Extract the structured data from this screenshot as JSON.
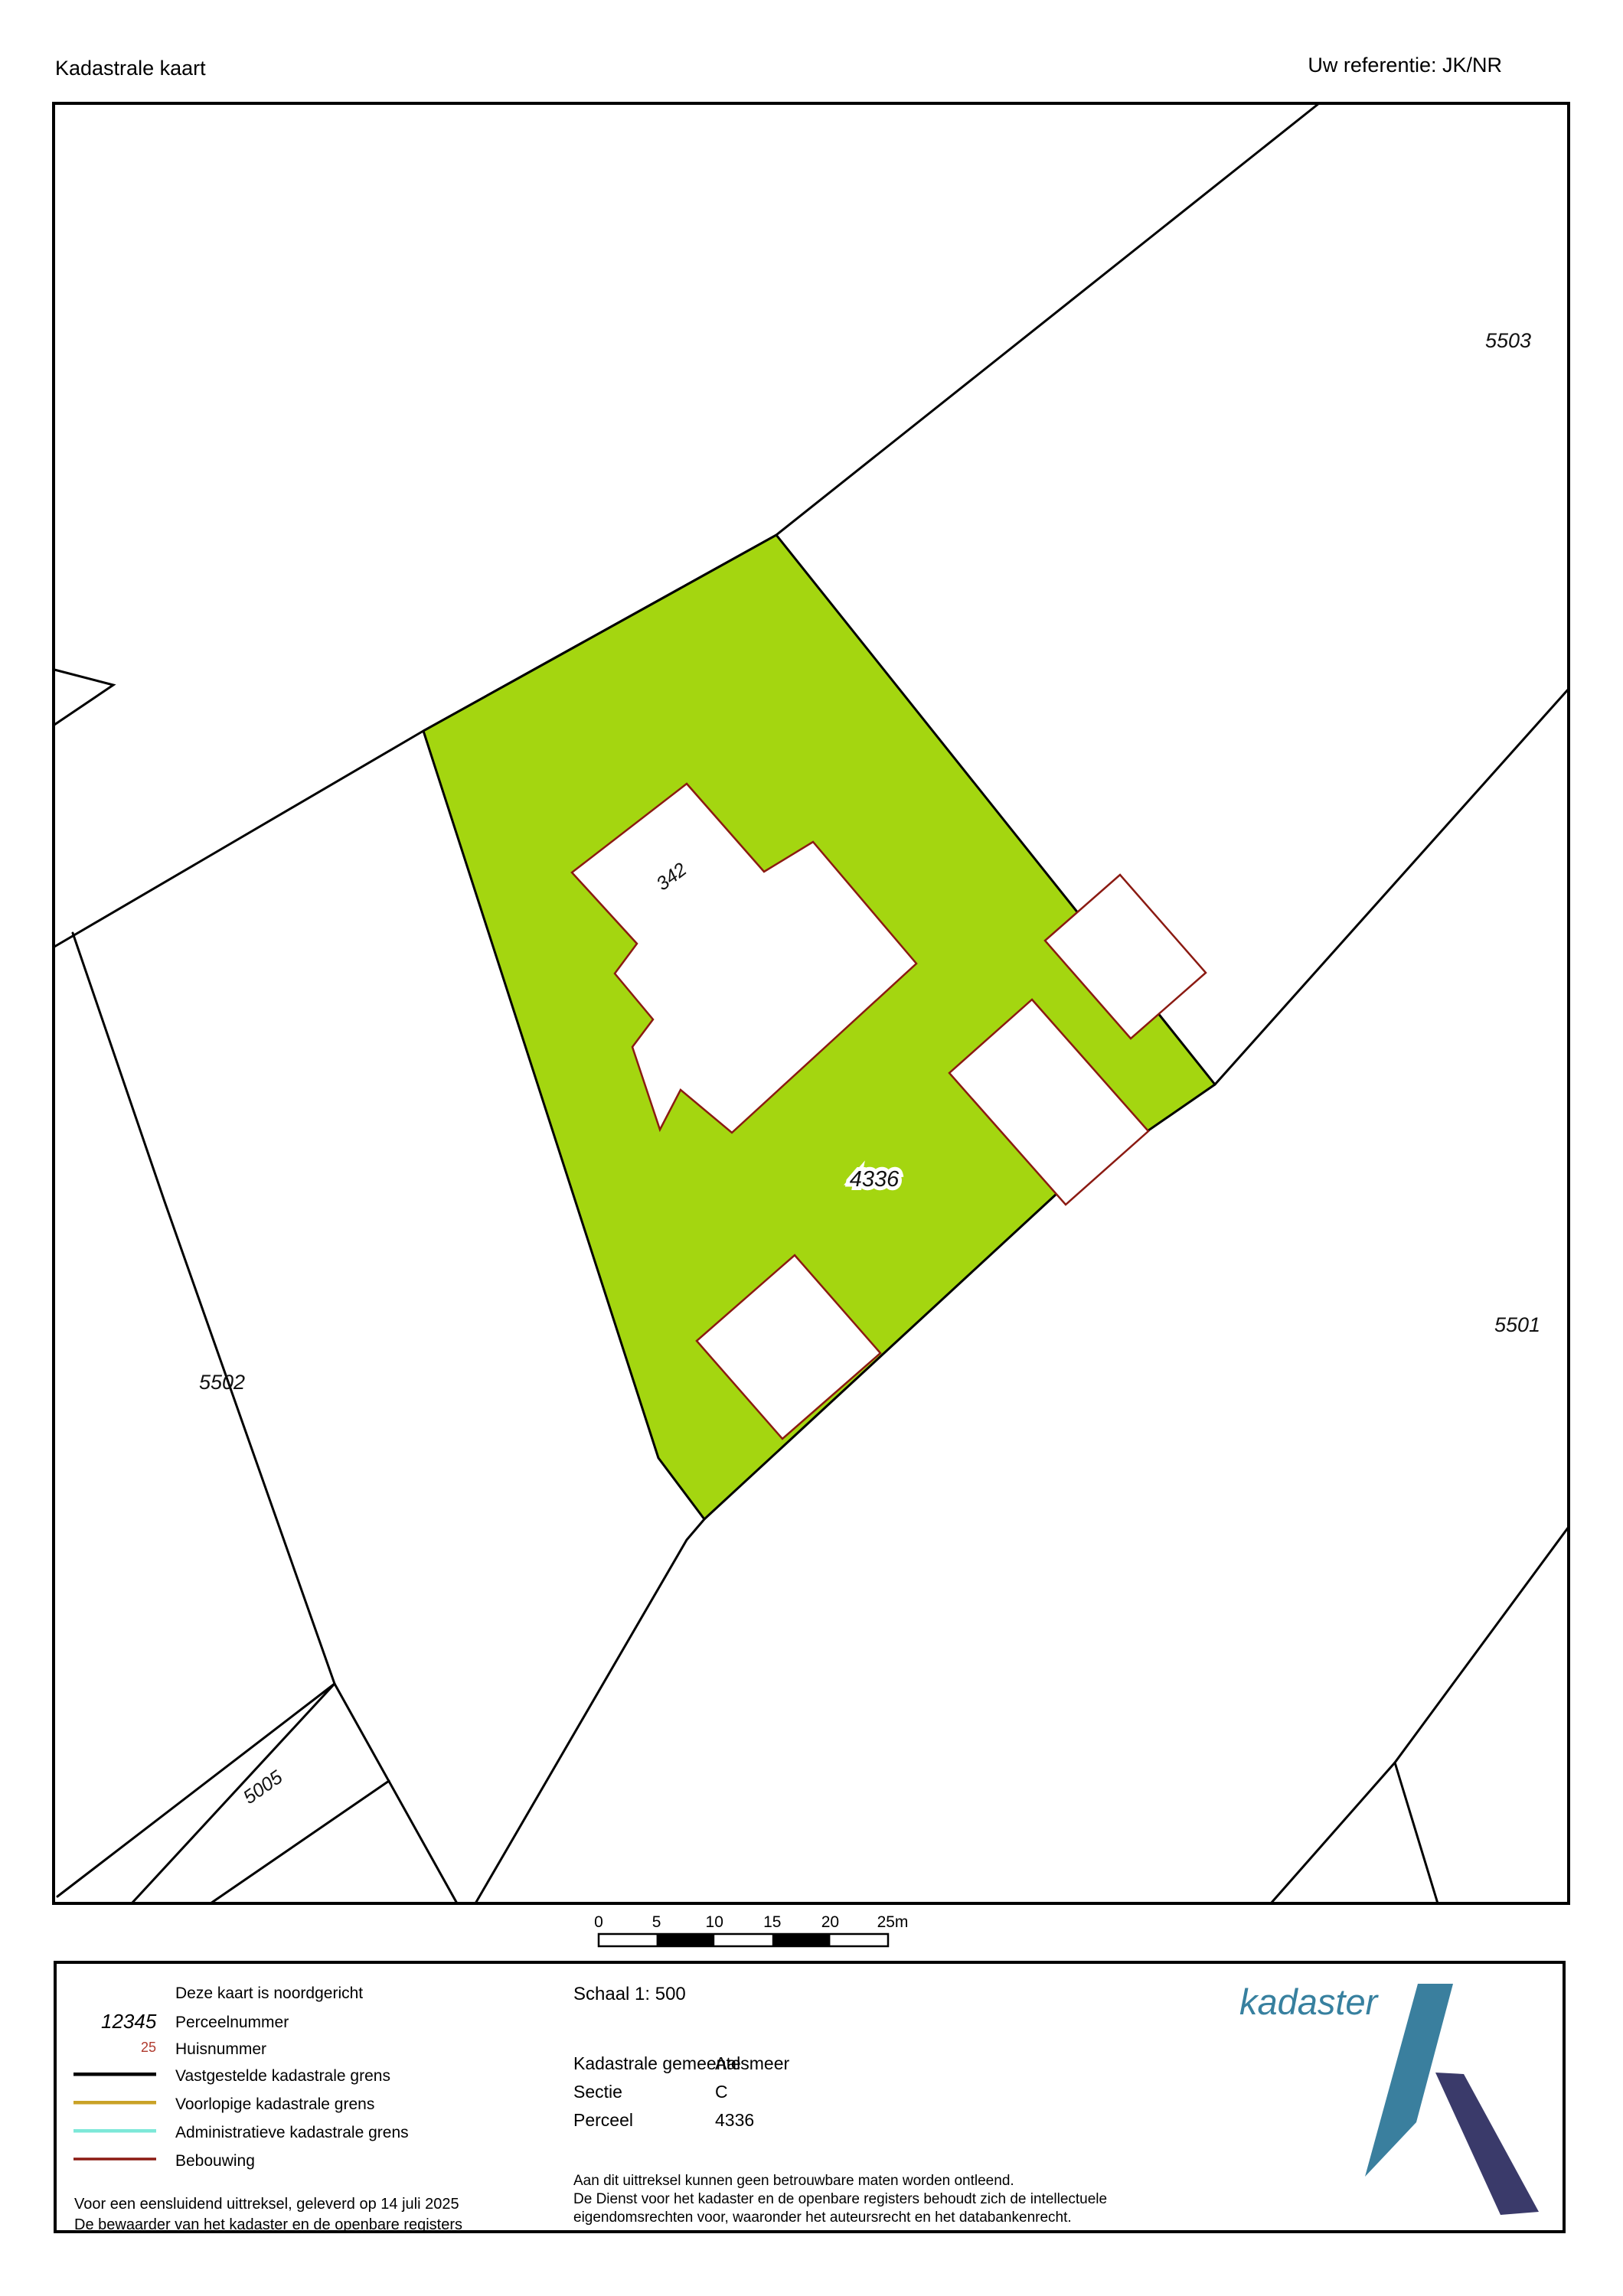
{
  "header": {
    "title": "Kadastrale kaart",
    "reference": "Uw referentie: JK/NR"
  },
  "map": {
    "parcels": {
      "p5503": "5503",
      "p5502": "5502",
      "p5501": "5501",
      "p5005": "5005",
      "p4336": "4336"
    },
    "house_number": "342",
    "colors": {
      "parcel_fill": "#a4d610",
      "boundary": "#000000",
      "building_outline": "#8b1a12",
      "building_fill": "#ffffff",
      "house_number": "#bf3a30"
    }
  },
  "scalebar": {
    "ticks": [
      "0",
      "5",
      "10",
      "15",
      "20",
      "25m"
    ]
  },
  "legend": {
    "north_note": "Deze kaart is noordgericht",
    "perceelnummer_sample": "12345",
    "perceelnummer_label": "Perceelnummer",
    "huisnummer_sample": "25",
    "huisnummer_color": "#b03a2e",
    "huisnummer_label": "Huisnummer",
    "lines": [
      {
        "color": "#000000",
        "label": "Vastgestelde kadastrale grens"
      },
      {
        "color": "#c9a227",
        "label": "Voorlopige kadastrale grens"
      },
      {
        "color": "#7de8d8",
        "label": "Administratieve kadastrale grens"
      },
      {
        "color": "#8b1a12",
        "label": "Bebouwing"
      }
    ],
    "delivery_line1": "Voor een eensluidend uittreksel, geleverd op 14 juli 2025",
    "delivery_line2": "De bewaarder van het kadaster en de openbare registers"
  },
  "details": {
    "scale_text": "Schaal 1: 500",
    "rows": [
      {
        "label": "Kadastrale gemeente",
        "value": "Aalsmeer"
      },
      {
        "label": "Sectie",
        "value": "C"
      },
      {
        "label": "Perceel",
        "value": "4336"
      }
    ],
    "disclaimer": [
      "Aan dit uittreksel kunnen geen betrouwbare maten worden ontleend.",
      "De Dienst voor het kadaster en de openbare registers behoudt zich de intellectuele",
      "eigendomsrechten voor, waaronder het auteursrecht en het databankenrecht."
    ]
  },
  "logo": {
    "text": "kadaster",
    "text_color": "#37809f",
    "blade_color": "#3a7f9e",
    "bar_color": "#3a3a6a"
  }
}
